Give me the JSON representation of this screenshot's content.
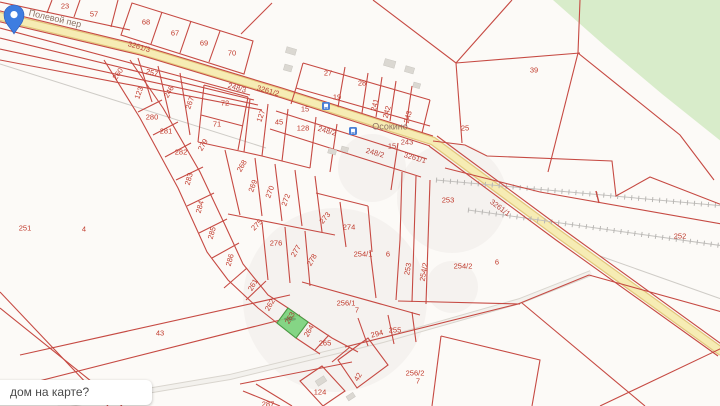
{
  "map": {
    "place_labels": [
      {
        "text": "Осокино",
        "x": 390,
        "y": 127,
        "rot": 0
      },
      {
        "text": "Полевой пер",
        "x": 55,
        "y": 19,
        "rot": 13
      }
    ],
    "tooltip": {
      "text": "дом на карте?"
    },
    "selected_parcel": {
      "number": "263",
      "x": 290,
      "y": 318,
      "rot": -60
    },
    "pin": {
      "type": "location-pin"
    },
    "poi_icons": [
      {
        "name": "bus-stop-icon",
        "x": 326,
        "y": 106
      },
      {
        "name": "bus-stop-icon",
        "x": 353,
        "y": 131
      }
    ],
    "labels": [
      {
        "text": "23",
        "x": 65,
        "y": 6,
        "rot": 0,
        "type": "parcel"
      },
      {
        "text": "57",
        "x": 94,
        "y": 14,
        "rot": 0,
        "type": "parcel"
      },
      {
        "text": "68",
        "x": 146,
        "y": 22,
        "rot": 0,
        "type": "parcel"
      },
      {
        "text": "67",
        "x": 175,
        "y": 33,
        "rot": 0,
        "type": "parcel"
      },
      {
        "text": "69",
        "x": 204,
        "y": 43,
        "rot": 0,
        "type": "parcel"
      },
      {
        "text": "70",
        "x": 232,
        "y": 53,
        "rot": 0,
        "type": "parcel"
      },
      {
        "text": "3261/3",
        "x": 139,
        "y": 47,
        "rot": 16,
        "type": "road"
      },
      {
        "text": "248/3",
        "x": 237,
        "y": 88,
        "rot": 16,
        "type": "road"
      },
      {
        "text": "3261/2",
        "x": 268,
        "y": 91,
        "rot": 16,
        "type": "road"
      },
      {
        "text": "27",
        "x": 328,
        "y": 73,
        "rot": 0,
        "type": "parcel"
      },
      {
        "text": "28",
        "x": 362,
        "y": 83,
        "rot": 0,
        "type": "parcel"
      },
      {
        "text": "19",
        "x": 337,
        "y": 97,
        "rot": 0,
        "type": "parcel"
      },
      {
        "text": "15",
        "x": 305,
        "y": 109,
        "rot": 0,
        "type": "road"
      },
      {
        "text": "39",
        "x": 534,
        "y": 70,
        "rot": 0,
        "type": "parcel"
      },
      {
        "text": "25",
        "x": 465,
        "y": 128,
        "rot": 0,
        "type": "parcel"
      },
      {
        "text": "241",
        "x": 375,
        "y": 105,
        "rot": -75,
        "type": "parcel"
      },
      {
        "text": "242",
        "x": 387,
        "y": 112,
        "rot": -75,
        "type": "parcel"
      },
      {
        "text": "243",
        "x": 408,
        "y": 117,
        "rot": -75,
        "type": "parcel"
      },
      {
        "text": "72",
        "x": 225,
        "y": 103,
        "rot": 0,
        "type": "parcel"
      },
      {
        "text": "71",
        "x": 217,
        "y": 124,
        "rot": 0,
        "type": "parcel"
      },
      {
        "text": "127",
        "x": 261,
        "y": 116,
        "rot": -70,
        "type": "parcel"
      },
      {
        "text": "45",
        "x": 279,
        "y": 122,
        "rot": 0,
        "type": "parcel"
      },
      {
        "text": "128",
        "x": 303,
        "y": 128,
        "rot": 0,
        "type": "parcel"
      },
      {
        "text": "248/2",
        "x": 327,
        "y": 131,
        "rot": 16,
        "type": "road"
      },
      {
        "text": "15",
        "x": 392,
        "y": 146,
        "rot": 0,
        "type": "road"
      },
      {
        "text": "243",
        "x": 407,
        "y": 142,
        "rot": 0,
        "type": "road"
      },
      {
        "text": "248/2",
        "x": 375,
        "y": 153,
        "rot": 16,
        "type": "road"
      },
      {
        "text": "3261/1",
        "x": 415,
        "y": 158,
        "rot": 16,
        "type": "road"
      },
      {
        "text": "3261/1",
        "x": 500,
        "y": 208,
        "rot": 37,
        "type": "road"
      },
      {
        "text": "257",
        "x": 152,
        "y": 73,
        "rot": 14,
        "type": "parcel"
      },
      {
        "text": "260",
        "x": 118,
        "y": 74,
        "rot": -55,
        "type": "parcel"
      },
      {
        "text": "123",
        "x": 139,
        "y": 93,
        "rot": -70,
        "type": "parcel"
      },
      {
        "text": "246",
        "x": 169,
        "y": 92,
        "rot": -60,
        "type": "parcel"
      },
      {
        "text": "267",
        "x": 190,
        "y": 103,
        "rot": -70,
        "type": "parcel"
      },
      {
        "text": "280",
        "x": 152,
        "y": 117,
        "rot": 0,
        "type": "parcel"
      },
      {
        "text": "281",
        "x": 166,
        "y": 131,
        "rot": 0,
        "type": "parcel"
      },
      {
        "text": "282",
        "x": 181,
        "y": 152,
        "rot": 0,
        "type": "parcel"
      },
      {
        "text": "283",
        "x": 189,
        "y": 179,
        "rot": -75,
        "type": "parcel"
      },
      {
        "text": "284",
        "x": 200,
        "y": 207,
        "rot": -75,
        "type": "parcel"
      },
      {
        "text": "285",
        "x": 212,
        "y": 233,
        "rot": -75,
        "type": "parcel"
      },
      {
        "text": "286",
        "x": 230,
        "y": 260,
        "rot": -75,
        "type": "parcel"
      },
      {
        "text": "279",
        "x": 203,
        "y": 145,
        "rot": -60,
        "type": "parcel"
      },
      {
        "text": "268",
        "x": 242,
        "y": 166,
        "rot": -60,
        "type": "parcel"
      },
      {
        "text": "269",
        "x": 253,
        "y": 186,
        "rot": -70,
        "type": "parcel"
      },
      {
        "text": "270",
        "x": 270,
        "y": 192,
        "rot": -70,
        "type": "parcel"
      },
      {
        "text": "272",
        "x": 286,
        "y": 200,
        "rot": -70,
        "type": "parcel"
      },
      {
        "text": "273",
        "x": 325,
        "y": 218,
        "rot": -50,
        "type": "parcel"
      },
      {
        "text": "274",
        "x": 349,
        "y": 227,
        "rot": 0,
        "type": "parcel"
      },
      {
        "text": "275",
        "x": 257,
        "y": 225,
        "rot": -45,
        "type": "parcel"
      },
      {
        "text": "276",
        "x": 276,
        "y": 243,
        "rot": 0,
        "type": "parcel"
      },
      {
        "text": "277",
        "x": 296,
        "y": 251,
        "rot": -60,
        "type": "parcel"
      },
      {
        "text": "278",
        "x": 312,
        "y": 260,
        "rot": -60,
        "type": "parcel"
      },
      {
        "text": "251",
        "x": 25,
        "y": 228,
        "rot": 0,
        "type": "parcel"
      },
      {
        "text": "4",
        "x": 84,
        "y": 229,
        "rot": 0,
        "type": "parcel"
      },
      {
        "text": "43",
        "x": 160,
        "y": 333,
        "rot": 0,
        "type": "parcel"
      },
      {
        "text": "253",
        "x": 448,
        "y": 200,
        "rot": 0,
        "type": "parcel"
      },
      {
        "text": "252",
        "x": 680,
        "y": 236,
        "rot": 0,
        "type": "parcel"
      },
      {
        "text": "253",
        "x": 408,
        "y": 269,
        "rot": -80,
        "type": "parcel"
      },
      {
        "text": "254/2",
        "x": 424,
        "y": 272,
        "rot": -80,
        "type": "parcel"
      },
      {
        "text": "254/2",
        "x": 463,
        "y": 266,
        "rot": 0,
        "type": "parcel"
      },
      {
        "text": "6",
        "x": 497,
        "y": 262,
        "rot": 0,
        "type": "parcel"
      },
      {
        "text": "254/1",
        "x": 363,
        "y": 254,
        "rot": 0,
        "type": "parcel"
      },
      {
        "text": "6",
        "x": 388,
        "y": 254,
        "rot": 0,
        "type": "parcel"
      },
      {
        "text": "256/1",
        "x": 346,
        "y": 303,
        "rot": 0,
        "type": "parcel"
      },
      {
        "text": "7",
        "x": 357,
        "y": 310,
        "rot": 0,
        "type": "parcel"
      },
      {
        "text": "294",
        "x": 377,
        "y": 334,
        "rot": -15,
        "type": "parcel"
      },
      {
        "text": "255",
        "x": 395,
        "y": 330,
        "rot": 0,
        "type": "parcel"
      },
      {
        "text": "256/2",
        "x": 415,
        "y": 373,
        "rot": 0,
        "type": "parcel"
      },
      {
        "text": "7",
        "x": 418,
        "y": 381,
        "rot": 0,
        "type": "parcel"
      },
      {
        "text": "261",
        "x": 253,
        "y": 285,
        "rot": -60,
        "type": "parcel"
      },
      {
        "text": "262",
        "x": 270,
        "y": 305,
        "rot": -60,
        "type": "parcel"
      },
      {
        "text": "264",
        "x": 309,
        "y": 331,
        "rot": -60,
        "type": "parcel"
      },
      {
        "text": "265",
        "x": 325,
        "y": 343,
        "rot": 0,
        "type": "parcel"
      },
      {
        "text": "124",
        "x": 320,
        "y": 392,
        "rot": 0,
        "type": "parcel"
      },
      {
        "text": "42",
        "x": 358,
        "y": 377,
        "rot": -60,
        "type": "parcel"
      },
      {
        "text": "287",
        "x": 268,
        "y": 404,
        "rot": 0,
        "type": "parcel"
      }
    ],
    "colors": {
      "boundary": "#c64a43",
      "road_fill": "#f6ecb4",
      "road_casing": "#e3c77d",
      "minor_road": "#f3f1ed",
      "forest": "#d8ecca",
      "railway": "#b9b7b4",
      "selected_fill": "#79d279",
      "selected_border": "#43a047",
      "pin": "#3e7de0",
      "background": "#fcfaf7",
      "parcel_label": "#c0392b",
      "place_label": "#8d7264",
      "building": "#dbd8d2"
    }
  }
}
